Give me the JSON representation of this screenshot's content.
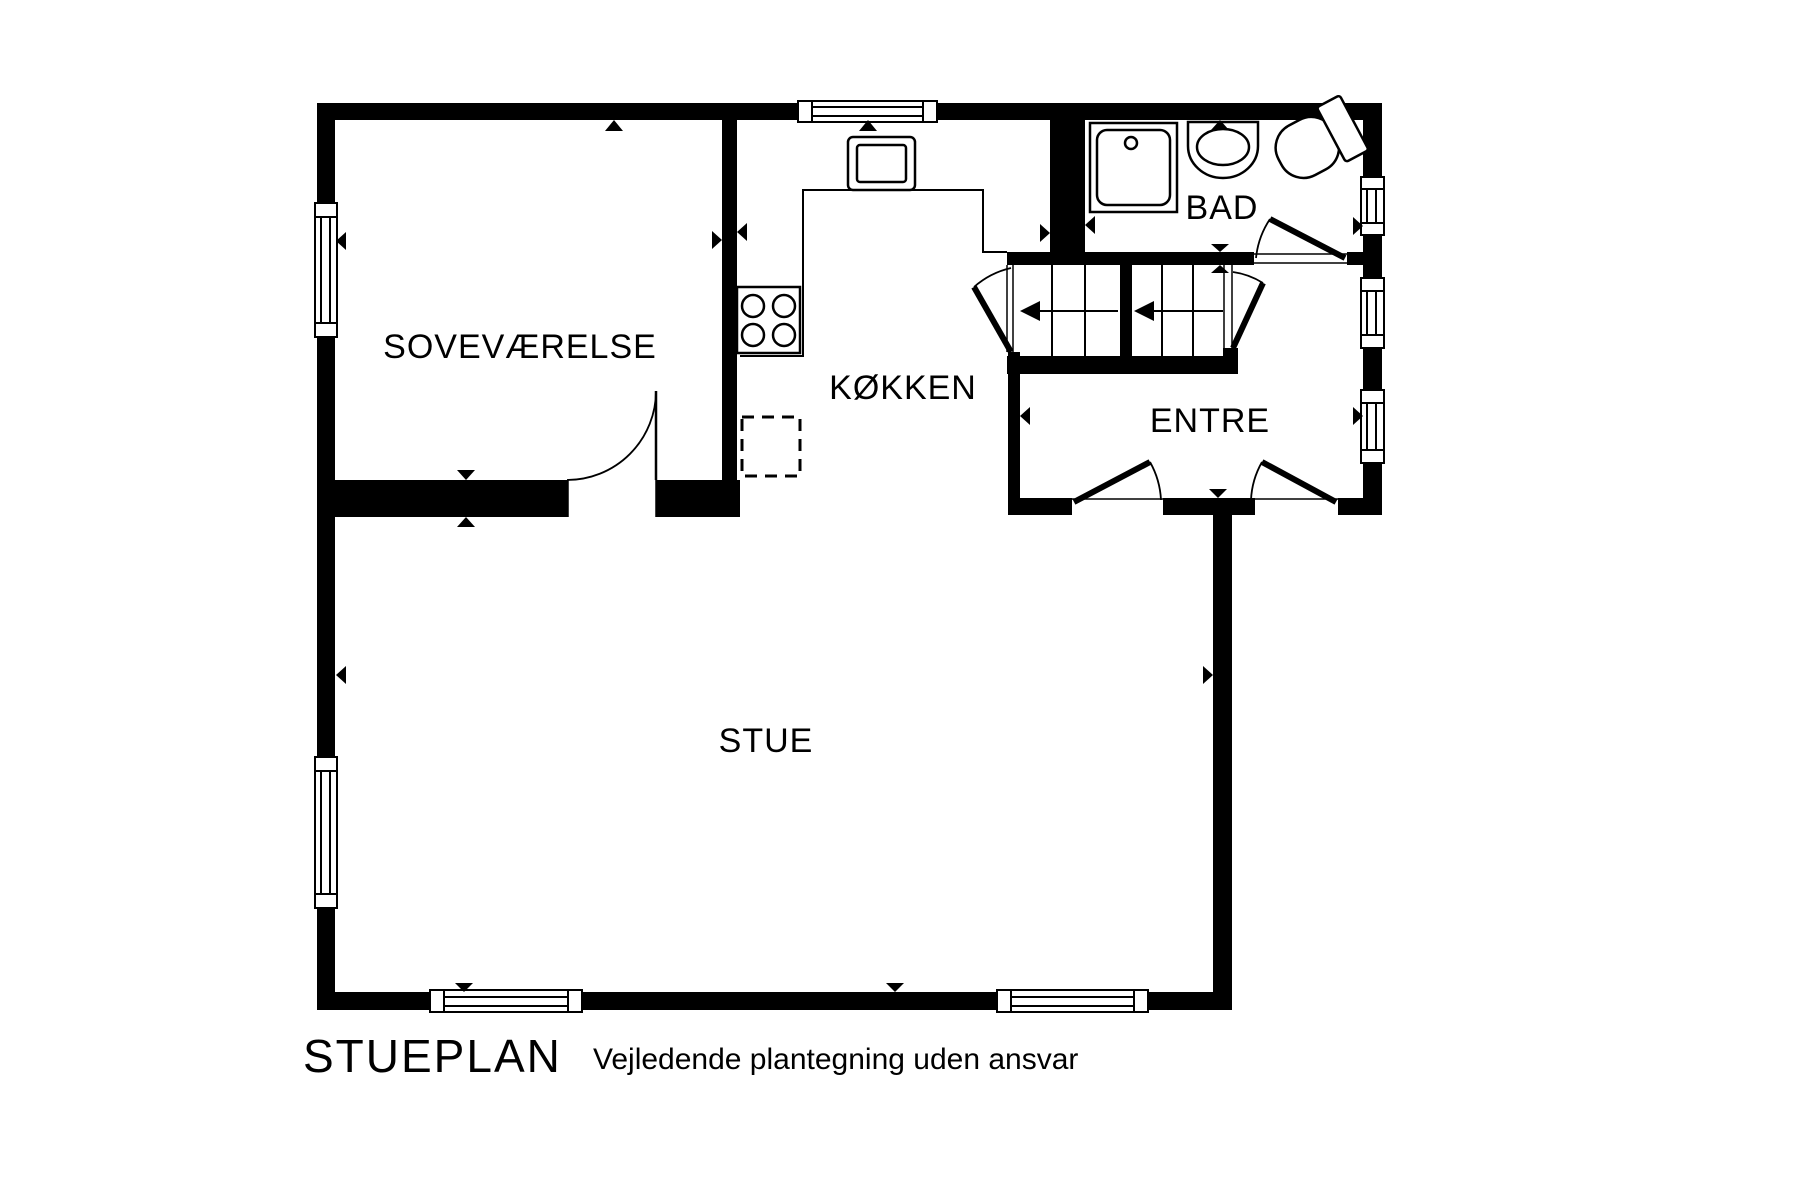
{
  "colors": {
    "background": "#ffffff",
    "line": "#000000",
    "title_text": "#311911"
  },
  "plan": {
    "title": "STUEPLAN",
    "subtitle": "Vejledende plantegning uden ansvar",
    "rooms": {
      "bedroom": "SOVEVÆRELSE",
      "kitchen": "KØKKEN",
      "bath": "BAD",
      "entry": "ENTRE",
      "living": "STUE"
    }
  }
}
